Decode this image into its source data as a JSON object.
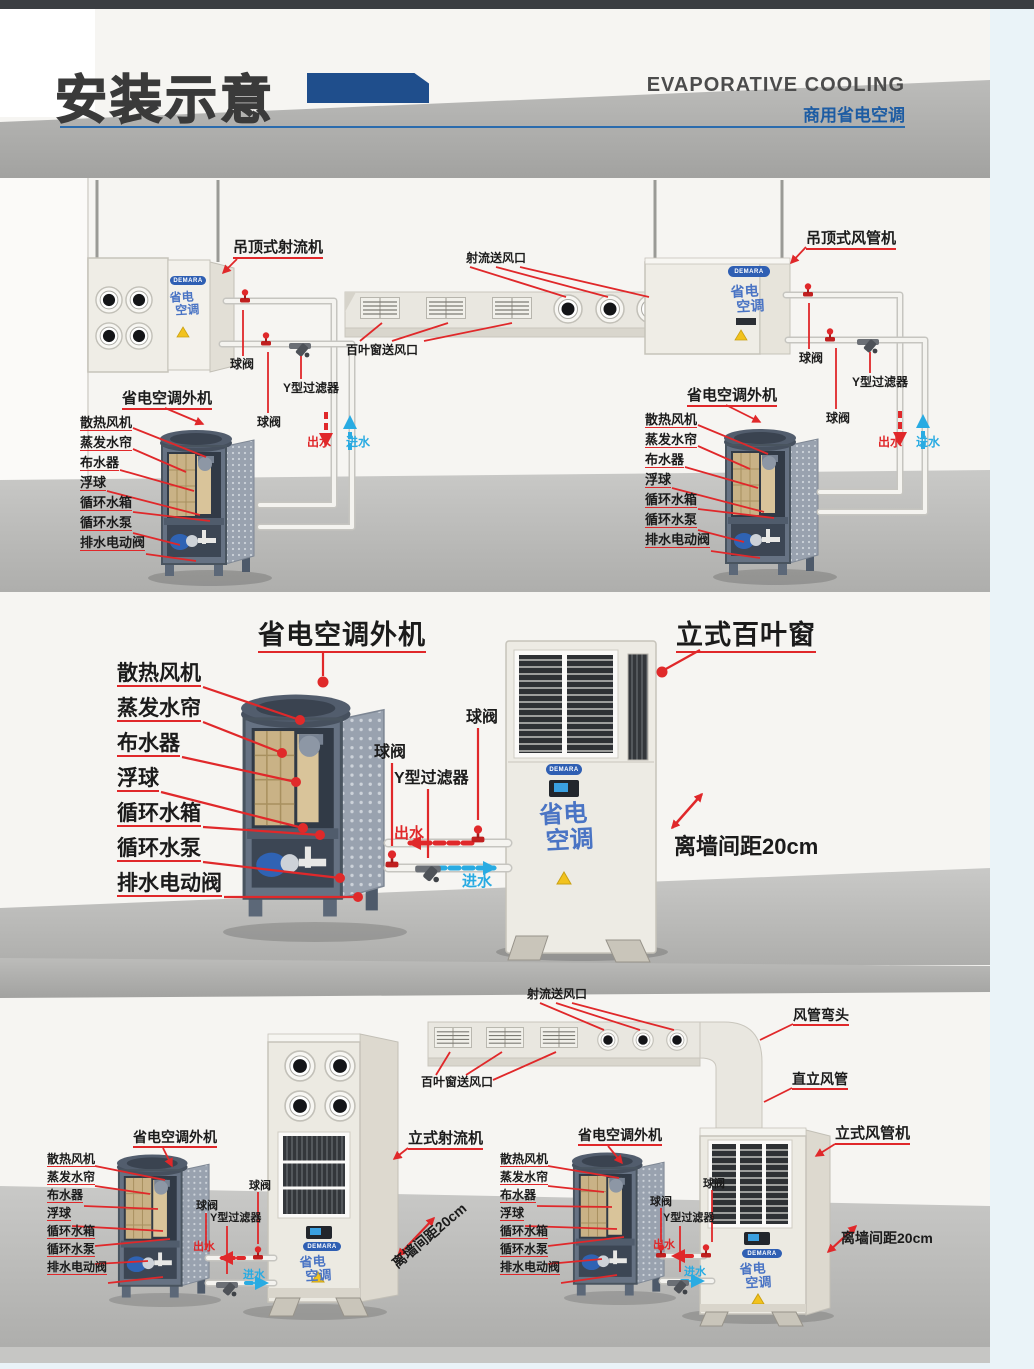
{
  "header": {
    "title": "安装示意",
    "subtitle_en": "EVAPORATIVE COOLING",
    "subtitle_zh": "商用省电空调"
  },
  "brand": {
    "name_en": "DEMARA",
    "logo_line1": "省电",
    "logo_line2": "空调"
  },
  "units": {
    "outdoor": "省电空调外机",
    "ceiling_jet": "吊顶式射流机",
    "ceiling_duct": "吊顶式风管机",
    "floor_louver": "立式百叶窗",
    "floor_jet": "立式射流机",
    "floor_duct": "立式风管机"
  },
  "parts": [
    "散热风机",
    "蒸发水帘",
    "布水器",
    "浮球",
    "循环水箱",
    "循环水泵",
    "排水电动阀"
  ],
  "plumbing": {
    "ball_valve": "球阀",
    "y_filter": "Y型过滤器",
    "water_out": "出水",
    "water_in": "进水"
  },
  "outlets": {
    "jet": "射流送风口",
    "louver": "百叶窗送风口"
  },
  "duct_parts": {
    "elbow": "风管弯头",
    "riser": "直立风管"
  },
  "annotations": {
    "wall_gap": "离墙间距20cm"
  },
  "colors": {
    "accent_blue": "#1f4e8c",
    "rule_blue": "#2a6bad",
    "leader_red": "#e0282a",
    "water_in_blue": "#29abe2",
    "brand_blue": "#4a74c4",
    "cabinet_slate": "#667283",
    "pad_tan": "#c9b286",
    "panel_cream": "#efede6"
  }
}
